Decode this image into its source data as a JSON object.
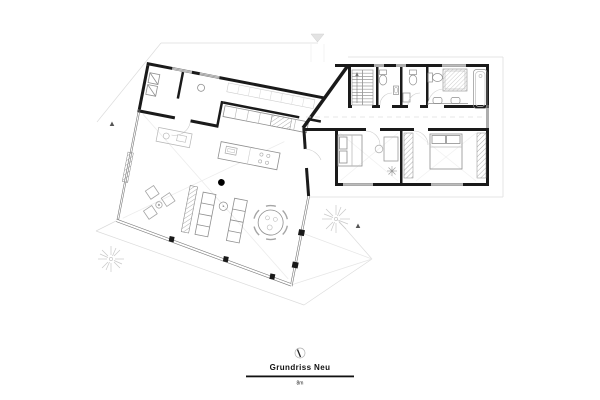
{
  "document": {
    "kind": "architectural-floor-plan-drawing",
    "background": "#ffffff"
  },
  "title_block": {
    "title": "Grundriss Neu",
    "scale_label": "8m",
    "north_symbol": "north-arrow-icon"
  },
  "colors": {
    "wall": "#1a1a1a",
    "furniture_line": "#8f8f8f",
    "light_line": "#c9c9c9",
    "site_line": "#dcdcdc",
    "text": "#111111"
  },
  "plan": {
    "wings": [
      {
        "name": "living-wing",
        "rotation_deg": 11,
        "rooms": [
          "entry",
          "utility",
          "kitchen",
          "living-dining"
        ]
      },
      {
        "name": "bedroom-wing",
        "rotation_deg": 0,
        "rooms": [
          "stair",
          "wc-1",
          "wc-2",
          "bathroom",
          "corridor",
          "bedroom-1",
          "bedroom-2"
        ]
      }
    ],
    "symbols": [
      "stairs-icon",
      "toilet-icon",
      "sink-icon",
      "shower-icon",
      "bathtub-icon",
      "bed-icon",
      "wardrobe-icon",
      "sofa-icon",
      "dining-table-icon",
      "lounge-chair-icon",
      "kitchen-island-icon",
      "fireplace-icon",
      "column-icon",
      "tree-icon",
      "section-marker-icon",
      "north-arrow-icon"
    ]
  }
}
